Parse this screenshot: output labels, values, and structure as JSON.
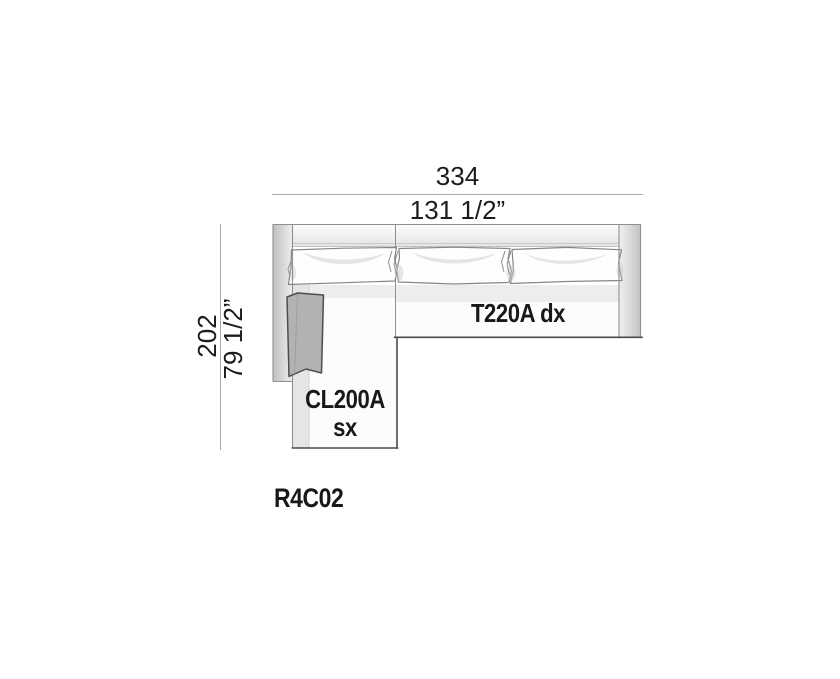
{
  "drawing": {
    "product_code": "R4C02",
    "dimensions": {
      "width_cm": "334",
      "width_in": "131 1/2”",
      "depth_cm": "202",
      "depth_in": "79 1/2”"
    },
    "modules": {
      "terminal_sofa": {
        "label": "T220A dx"
      },
      "chaise": {
        "line1": "CL200A",
        "line2": "sx"
      }
    },
    "colors": {
      "dimension_line": "#ababab",
      "frame_outline": "#8f8f8f",
      "dark_edge": "#4a4a4a",
      "armrest_pillow_fill": "#b2b2b2",
      "upholstery_shade": "#ededed"
    }
  }
}
